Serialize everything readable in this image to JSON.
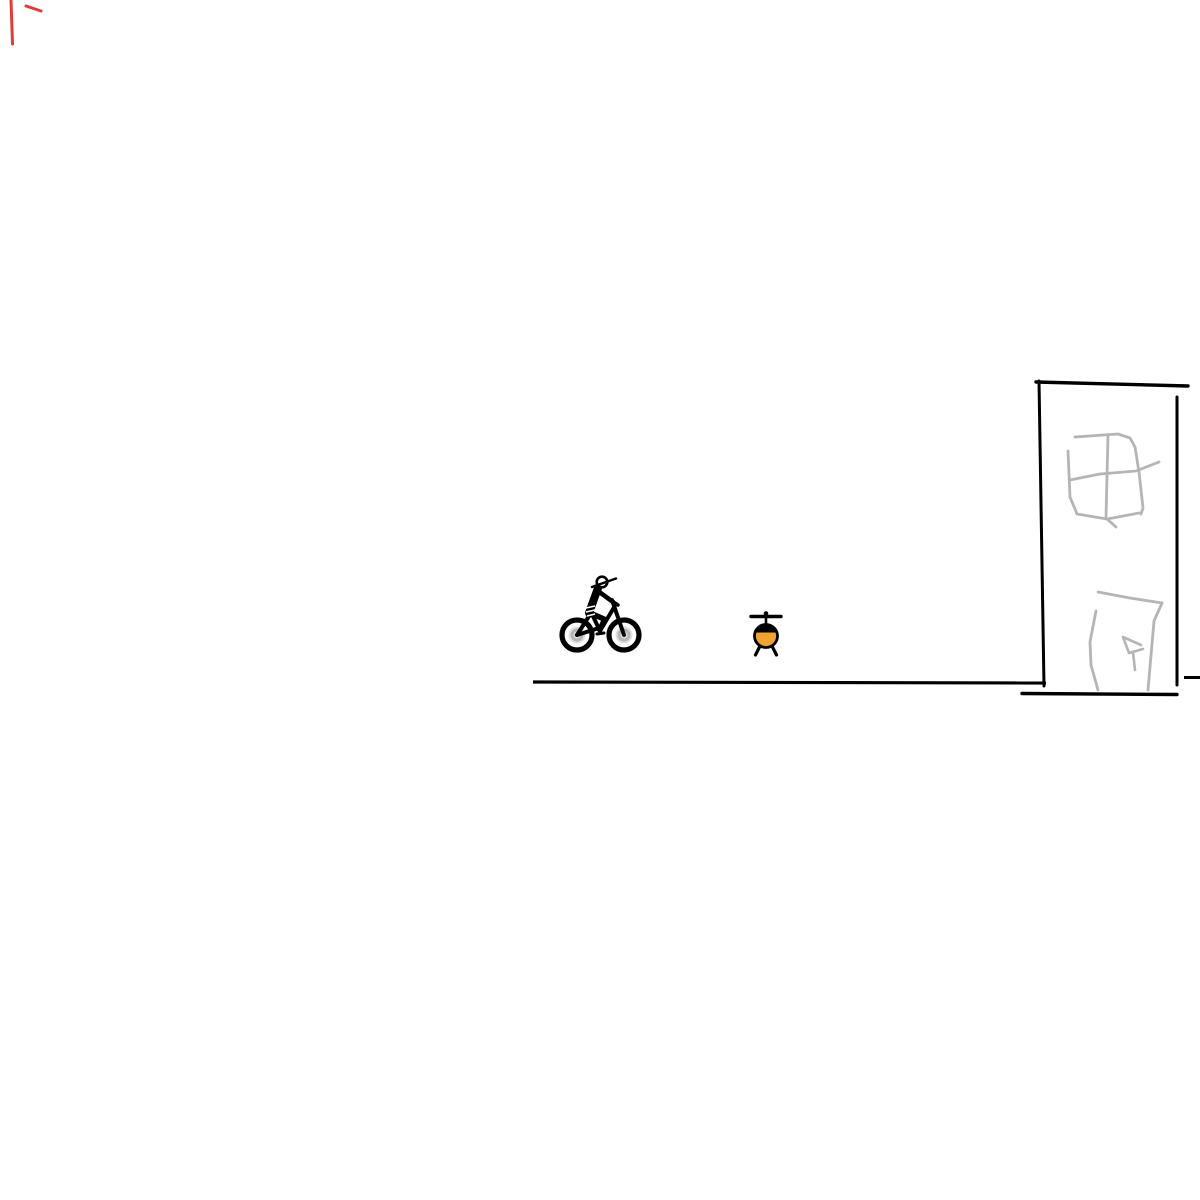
{
  "scene": {
    "description": "Hand-drawn whiteboard sketch: a person on a bicycle riding toward a small orange helicopter and a tall sketched building standing on a flat ground line; faint red pen marks in the top-left corner",
    "background": "#ffffff",
    "palette": {
      "ink_black": "#000000",
      "sketch_gray": "#b5b5b5",
      "helicopter_orange": "#f0a232",
      "pen_red": "#e23b3b",
      "wheel_hub_light": "#e0e0e0",
      "wheel_hub_ring": "#b4b4b4",
      "white": "#ffffff"
    }
  },
  "sketch": {
    "red_marks": {
      "label": "red-pen-marks",
      "shapes": [
        {
          "tag": "path",
          "d": "M 11 0 L 12.5 44",
          "stroke": "#e23b3b",
          "stroke-width": 3,
          "fill": "none",
          "stroke-linecap": "round"
        },
        {
          "tag": "path",
          "d": "M 26 6 L 41 11",
          "stroke": "#e23b3b",
          "stroke-width": 3,
          "fill": "none",
          "stroke-linecap": "round"
        }
      ]
    },
    "ground": {
      "label": "ground-line",
      "shapes": [
        {
          "tag": "path",
          "d": "M 533 682 L 1046 683",
          "stroke": "#000000",
          "stroke-width": 3.2,
          "fill": "none",
          "stroke-linecap": "butt"
        }
      ]
    },
    "cyclist": {
      "label": "person-mountain-biking",
      "shapes": [
        {
          "tag": "circle",
          "cx": 577,
          "cy": 635,
          "r": 15,
          "fill": "none",
          "stroke": "#000000",
          "stroke-width": 5.2
        },
        {
          "tag": "circle",
          "cx": 577,
          "cy": 635,
          "r": 8.5,
          "fill": "#e0e0e0"
        },
        {
          "tag": "circle",
          "cx": 577,
          "cy": 635,
          "r": 5,
          "fill": "none",
          "stroke": "#b4b4b4",
          "stroke-width": 3
        },
        {
          "tag": "circle",
          "cx": 624,
          "cy": 635,
          "r": 15,
          "fill": "none",
          "stroke": "#000000",
          "stroke-width": 5.2
        },
        {
          "tag": "circle",
          "cx": 624,
          "cy": 635,
          "r": 8.5,
          "fill": "#e0e0e0"
        },
        {
          "tag": "circle",
          "cx": 624,
          "cy": 635,
          "r": 5,
          "fill": "none",
          "stroke": "#b4b4b4",
          "stroke-width": 3
        },
        {
          "tag": "path",
          "d": "M 577 635 L 599 628",
          "stroke": "#000000",
          "stroke-width": 4,
          "fill": "none",
          "stroke-linecap": "round"
        },
        {
          "tag": "path",
          "d": "M 577 635 L 591 613",
          "stroke": "#000000",
          "stroke-width": 4,
          "fill": "none",
          "stroke-linecap": "round"
        },
        {
          "tag": "path",
          "d": "M 591 612 L 600 631",
          "stroke": "#000000",
          "stroke-width": 4,
          "fill": "none",
          "stroke-linecap": "round"
        },
        {
          "tag": "path",
          "d": "M 600 631 L 616 604",
          "stroke": "#000000",
          "stroke-width": 4,
          "fill": "none",
          "stroke-linecap": "round"
        },
        {
          "tag": "path",
          "d": "M 612 600 L 624 635",
          "stroke": "#000000",
          "stroke-width": 4,
          "fill": "none",
          "stroke-linecap": "round"
        },
        {
          "tag": "path",
          "d": "M 608 598 L 618 605",
          "stroke": "#000000",
          "stroke-width": 3.5,
          "fill": "none",
          "stroke-linecap": "round"
        },
        {
          "tag": "circle",
          "cx": 600,
          "cy": 630,
          "r": 2.6,
          "fill": "#000000"
        },
        {
          "tag": "path",
          "d": "M 597 634 L 604 633",
          "stroke": "#000000",
          "stroke-width": 3,
          "fill": "none",
          "stroke-linecap": "round"
        },
        {
          "tag": "path",
          "d": "M 598 588 L 589 613",
          "stroke": "#000000",
          "stroke-width": 8,
          "fill": "none",
          "stroke-linecap": "round"
        },
        {
          "tag": "circle",
          "cx": 590,
          "cy": 613,
          "r": 4.2,
          "fill": "#000000"
        },
        {
          "tag": "path",
          "d": "M 598 591 L 613 602",
          "stroke": "#000000",
          "stroke-width": 4.5,
          "fill": "none",
          "stroke-linecap": "round"
        },
        {
          "tag": "path",
          "d": "M 590 613 L 604 619",
          "stroke": "#000000",
          "stroke-width": 5.5,
          "fill": "none",
          "stroke-linecap": "round"
        },
        {
          "tag": "path",
          "d": "M 604 619 L 599 630",
          "stroke": "#000000",
          "stroke-width": 4,
          "fill": "none",
          "stroke-linecap": "round"
        },
        {
          "tag": "circle",
          "cx": 602,
          "cy": 582,
          "r": 5.3,
          "fill": "#ffffff",
          "stroke": "#000000",
          "stroke-width": 2.6
        },
        {
          "tag": "path",
          "d": "M 592 587 L 616 578.5",
          "stroke": "#000000",
          "stroke-width": 2.4,
          "fill": "none",
          "stroke-linecap": "round"
        },
        {
          "tag": "path",
          "d": "M 586 608 L 595 606",
          "stroke": "#ffffff",
          "stroke-width": 1.6,
          "fill": "none"
        },
        {
          "tag": "path",
          "d": "M 586 612 L 595 610",
          "stroke": "#ffffff",
          "stroke-width": 1.6,
          "fill": "none"
        },
        {
          "tag": "path",
          "d": "M 587 616 L 595 614",
          "stroke": "#ffffff",
          "stroke-width": 1.6,
          "fill": "none"
        }
      ]
    },
    "helicopter": {
      "label": "helicopter-front-view",
      "shapes": [
        {
          "tag": "path",
          "d": "M 751 616.5 L 781 616.5",
          "stroke": "#000000",
          "stroke-width": 3.4,
          "fill": "none",
          "stroke-linecap": "round"
        },
        {
          "tag": "circle",
          "cx": 766,
          "cy": 613.5,
          "r": 2.3,
          "fill": "#000000"
        },
        {
          "tag": "path",
          "d": "M 766 617 L 766 626",
          "stroke": "#000000",
          "stroke-width": 2.6,
          "fill": "none"
        },
        {
          "tag": "path",
          "d": "M 760 646 L 755.5 655",
          "stroke": "#000000",
          "stroke-width": 3.2,
          "fill": "none",
          "stroke-linecap": "round"
        },
        {
          "tag": "path",
          "d": "M 772 646 L 776.5 655",
          "stroke": "#000000",
          "stroke-width": 3.2,
          "fill": "none",
          "stroke-linecap": "round"
        },
        {
          "tag": "circle",
          "cx": 766,
          "cy": 636,
          "r": 11.5,
          "fill": "#f0a232",
          "stroke": "#000000",
          "stroke-width": 2.8
        },
        {
          "tag": "path",
          "d": "M 755.05 632.5 A 11.5 11.5 0 0 1 776.95 632.5 Z",
          "fill": "#000000"
        }
      ]
    },
    "building": {
      "label": "building-outline",
      "shapes": [
        {
          "tag": "path",
          "d": "M 1039 381 L 1044 686",
          "stroke": "#000000",
          "stroke-width": 3,
          "fill": "none",
          "stroke-linecap": "round"
        },
        {
          "tag": "path",
          "d": "M 1036 382 L 1188 386",
          "stroke": "#000000",
          "stroke-width": 3.4,
          "fill": "none",
          "stroke-linecap": "round"
        },
        {
          "tag": "path",
          "d": "M 1177 397 L 1177 685",
          "stroke": "#000000",
          "stroke-width": 3,
          "fill": "none",
          "stroke-linecap": "round"
        },
        {
          "tag": "path",
          "d": "M 1022 693.5 L 1177 694.5",
          "stroke": "#000000",
          "stroke-width": 3.4,
          "fill": "none",
          "stroke-linecap": "round"
        },
        {
          "tag": "path",
          "d": "M 1184 677.5 L 1200 677.5",
          "stroke": "#000000",
          "stroke-width": 3,
          "fill": "none",
          "stroke-linecap": "butt"
        }
      ]
    },
    "window": {
      "label": "sketched-window-with-cross",
      "shapes": [
        {
          "tag": "path",
          "d": "M 1075 437 L 1118 434 L 1130 438 L 1135 447",
          "stroke": "#b5b5b5",
          "stroke-width": 2.8,
          "fill": "none",
          "stroke-linecap": "round",
          "stroke-linejoin": "round"
        },
        {
          "tag": "path",
          "d": "M 1135 447 L 1139 472 L 1143 508 L 1141 514",
          "stroke": "#b5b5b5",
          "stroke-width": 2.8,
          "fill": "none",
          "stroke-linecap": "round",
          "stroke-linejoin": "round"
        },
        {
          "tag": "path",
          "d": "M 1077 514 L 1107 519 L 1139 513",
          "stroke": "#b5b5b5",
          "stroke-width": 2.8,
          "fill": "none",
          "stroke-linecap": "round",
          "stroke-linejoin": "round"
        },
        {
          "tag": "path",
          "d": "M 1107 519 L 1116 527",
          "stroke": "#b5b5b5",
          "stroke-width": 2.8,
          "fill": "none",
          "stroke-linecap": "round"
        },
        {
          "tag": "path",
          "d": "M 1068 451 L 1070 497 L 1077 514",
          "stroke": "#b5b5b5",
          "stroke-width": 2.8,
          "fill": "none",
          "stroke-linecap": "round",
          "stroke-linejoin": "round"
        },
        {
          "tag": "path",
          "d": "M 1070 480 L 1100 474 L 1136 471 L 1159 462",
          "stroke": "#b5b5b5",
          "stroke-width": 2.8,
          "fill": "none",
          "stroke-linecap": "round",
          "stroke-linejoin": "round"
        },
        {
          "tag": "path",
          "d": "M 1108 435 L 1106 518",
          "stroke": "#b5b5b5",
          "stroke-width": 2.8,
          "fill": "none",
          "stroke-linecap": "round"
        }
      ]
    },
    "door": {
      "label": "sketched-door-with-handle",
      "shapes": [
        {
          "tag": "path",
          "d": "M 1098 592 L 1130 598 L 1162 603",
          "stroke": "#b5b5b5",
          "stroke-width": 2.8,
          "fill": "none",
          "stroke-linecap": "round",
          "stroke-linejoin": "round"
        },
        {
          "tag": "path",
          "d": "M 1162 603 L 1154 621 L 1148 690",
          "stroke": "#b5b5b5",
          "stroke-width": 2.8,
          "fill": "none",
          "stroke-linecap": "round",
          "stroke-linejoin": "round"
        },
        {
          "tag": "path",
          "d": "M 1096 611 L 1090 642 L 1091 665 L 1098 690",
          "stroke": "#b5b5b5",
          "stroke-width": 2.8,
          "fill": "none",
          "stroke-linecap": "round",
          "stroke-linejoin": "round"
        },
        {
          "tag": "path",
          "d": "M 1141 645 L 1123 637 L 1129 653 L 1143 649",
          "stroke": "#b5b5b5",
          "stroke-width": 2.6,
          "fill": "none",
          "stroke-linecap": "round",
          "stroke-linejoin": "round"
        },
        {
          "tag": "path",
          "d": "M 1133 652 L 1135 670",
          "stroke": "#b5b5b5",
          "stroke-width": 2.6,
          "fill": "none",
          "stroke-linecap": "round"
        }
      ]
    }
  }
}
